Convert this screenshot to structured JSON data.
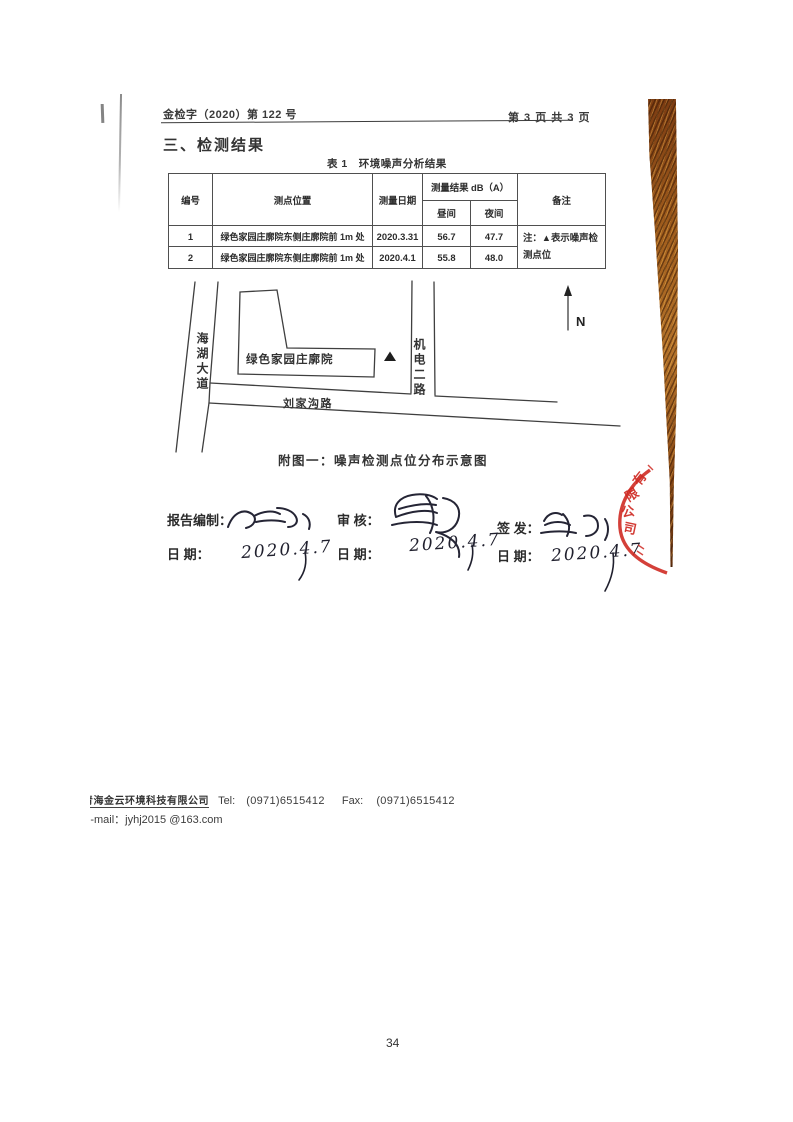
{
  "header": {
    "doc_number": "金检字（2020）第 122 号",
    "page_indicator": "第 3 页 共 3 页"
  },
  "section_title": "三、检测结果",
  "table": {
    "caption": "表 1　环境噪声分析结果",
    "headers": {
      "no": "编号",
      "location": "测点位置",
      "date": "测量日期",
      "result_group": "测量结果 dB（A）",
      "day": "昼间",
      "night": "夜间",
      "remark": "备注"
    },
    "rows": [
      {
        "no": "1",
        "location": "绿色家园庄廓院东侧庄廓院前 1m 处",
        "date": "2020.3.31",
        "day": "56.7",
        "night": "47.7"
      },
      {
        "no": "2",
        "location": "绿色家园庄廓院东侧庄廓院前 1m 处",
        "date": "2020.4.1",
        "day": "55.8",
        "night": "48.0"
      }
    ],
    "remark_note": "注：▲表示噪声检测点位"
  },
  "diagram": {
    "road_left_vertical": "海湖大道",
    "road_right_vertical": "机电二路",
    "road_horizontal": "刘家沟路",
    "building_label": "绿色家园庄廓院",
    "monitor_marker": "▲",
    "north_label": "N",
    "caption": "附图一：噪声检测点位分布示意图"
  },
  "signatures": {
    "preparer_label": "报告编制：",
    "reviewer_label": "审  核：",
    "issuer_label": "签 发：",
    "date_label_1": "日    期：",
    "date_label_2": "日  期：",
    "date_label_3": "日  期：",
    "date_1": "2020.4.7",
    "date_2": "2020.4.7",
    "date_3": "2020.4.7"
  },
  "stamp": {
    "chars": [
      "有",
      "限",
      "公",
      "司"
    ],
    "color": "#cf2b24"
  },
  "footer": {
    "company": "青海金云环境科技有限公司",
    "tel_label": "Tel:",
    "tel": "(0971)6515412",
    "fax_label": "Fax:",
    "fax": "(0971)6515412",
    "email_line": "E-mail：jyhj2015 @163.com"
  },
  "page_number": "34"
}
